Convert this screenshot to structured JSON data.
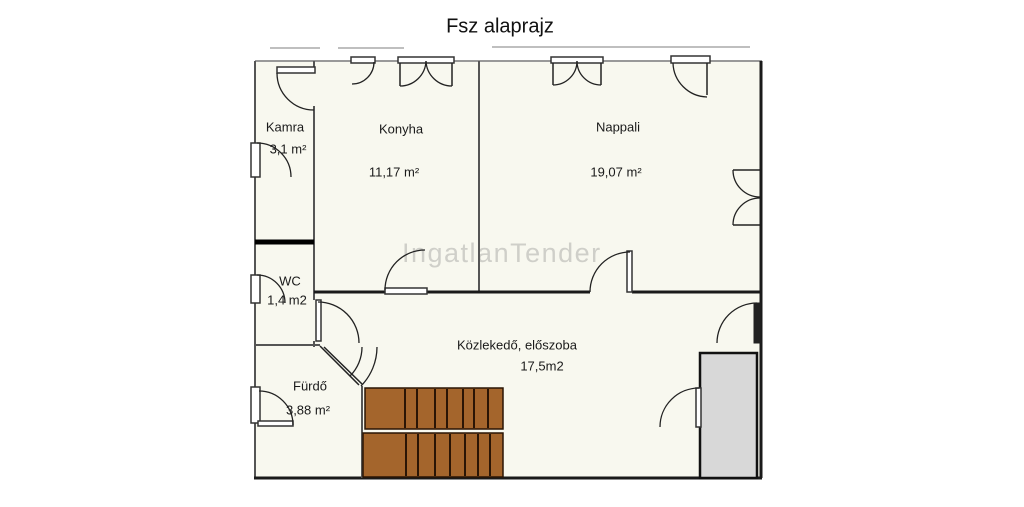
{
  "title": "Fsz alaprajz",
  "watermark": "IngatlanTender",
  "rooms": {
    "kamra": {
      "name": "Kamra",
      "area": "3,1 m²"
    },
    "konyha": {
      "name": "Konyha",
      "area": "11,17 m²"
    },
    "nappali": {
      "name": "Nappali",
      "area": "19,07 m²"
    },
    "wc": {
      "name": "WC",
      "area": "1,4 m2"
    },
    "kozlekedo": {
      "name": "Közlekedő, előszoba",
      "area": "17,5m2"
    },
    "furdo": {
      "name": "Fürdő",
      "area": "3,88 m²"
    }
  },
  "colors": {
    "floor": "#f8f8ef",
    "stairs": "#a4652c",
    "stair_edge": "#2a1505",
    "terrace": "#d8d8d8",
    "wall": "#333333",
    "watermark": "#cfcfc9"
  }
}
